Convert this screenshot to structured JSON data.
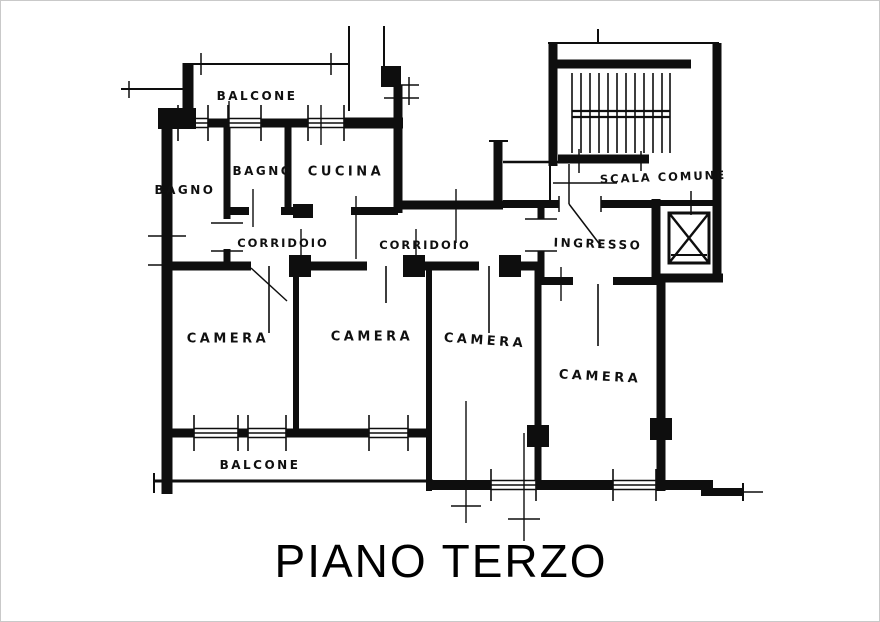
{
  "title": "PIANO TERZO",
  "plan": {
    "type": "apartment-floor-plan",
    "rooms": [
      {
        "name": "balcone-top",
        "label": "BALCONE"
      },
      {
        "name": "bagno-west",
        "label": "BAGNO"
      },
      {
        "name": "bagno-north",
        "label": "BAGNO"
      },
      {
        "name": "cucina",
        "label": "CUCINA"
      },
      {
        "name": "corridoio-west",
        "label": "CORRIDOIO"
      },
      {
        "name": "corridoio-east",
        "label": "CORRIDOIO"
      },
      {
        "name": "scala-comune",
        "label": "SCALA COMUNE"
      },
      {
        "name": "ingresso",
        "label": "INGRESSO"
      },
      {
        "name": "camera-1",
        "label": "CAMERA"
      },
      {
        "name": "camera-2",
        "label": "CAMERA"
      },
      {
        "name": "camera-3",
        "label": "CAMERA"
      },
      {
        "name": "camera-4",
        "label": "CAMERA"
      },
      {
        "name": "balcone-bottom",
        "label": "BALCONE"
      }
    ],
    "features": [
      {
        "name": "staircase",
        "description": "common stair, two flights with landing"
      },
      {
        "name": "elevator-shaft",
        "description": "lift shaft drawn with X"
      }
    ],
    "colors": {
      "ink": "#0e0e0e",
      "background": "#ffffff",
      "frame": "#c9c9c9"
    }
  }
}
